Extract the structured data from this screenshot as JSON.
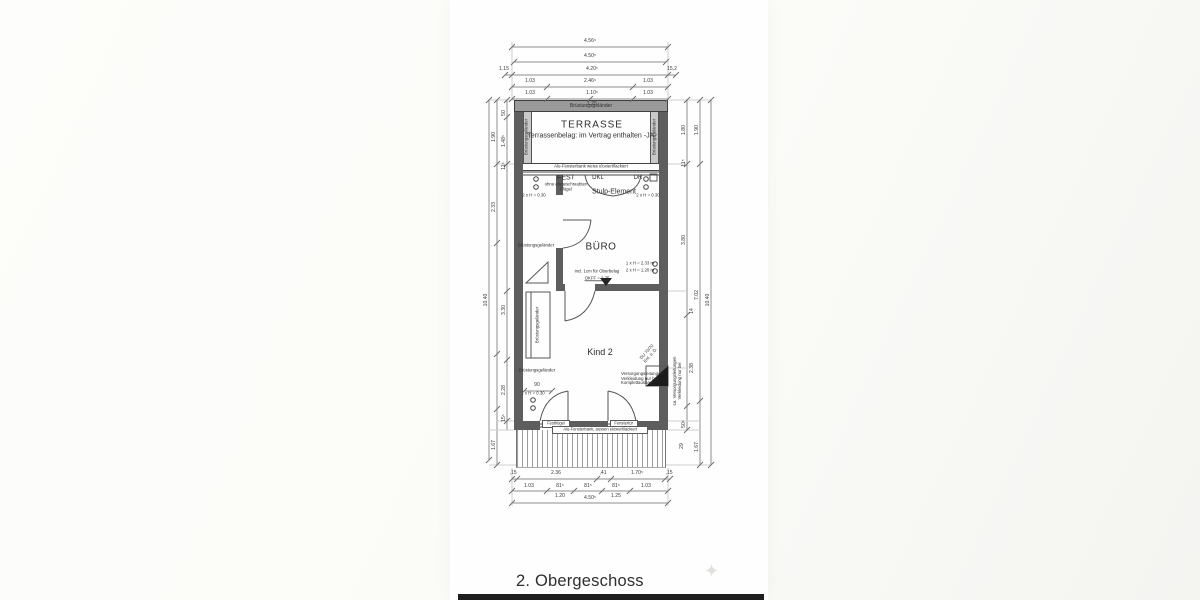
{
  "title": "2. Obergeschoss",
  "decor": {
    "sparkle": "✦"
  },
  "plan": {
    "rooms": {
      "terrace": "TERRASSE",
      "terrace_note": "Terrassenbelag: im Vertrag enthalten -JA-",
      "office": "BÜRO",
      "child": "Kind 2"
    },
    "labels": {
      "railing": "Brüstungsgeländer",
      "sill_top": "Alu-Fensterbank weiss eloxiert/lackiert",
      "sill_bottom": "Alu-Fensterbank, aussen eloxiert/lackiert",
      "fixed": "FEST",
      "fixed_sub1": "ohne eingeschraubten",
      "fixed_sub2": "Flügel",
      "dkl": "DKL",
      "dr": "DR",
      "stulp": "Stulp-Element",
      "sockets_030": "2 x H = 0.30",
      "floor_note1": "incl. 1cm für Oberbelag",
      "floor_note2": "OKFF = 2.75",
      "h1": "1 x H = 2.33 m",
      "h2": "2 x H = 1.20 m",
      "shower": "DU 70/70",
      "vent": "Ent. ü. D.",
      "supply1": "Versorgungsleitungen",
      "supply2": "Verkleidung nur bei",
      "supply3": "Komplettausbau",
      "supply_side1": "ca. Versorgungsleitungen",
      "supply_side2": "Verkleidung nur bei",
      "door_left": "Festflügel",
      "door_right": "Fenstertür",
      "dim_90": "90"
    }
  },
  "dims": {
    "top": {
      "t1": "4.56⁵",
      "t2": "4.50⁵",
      "t3l": "1.15",
      "t3": "4.20⁵",
      "t3r": "15,2",
      "t4l": "1.03",
      "t4": "2.46⁵",
      "t4r": "1.03",
      "t5l": "1.03",
      "t5": "1.10⁵",
      "t5r": "1.03",
      "t5sub": "1.25"
    },
    "bottom": {
      "b1a": ",15",
      "b1b": "2.36",
      "b1c": ",41",
      "b1d": "1.70⁵",
      "b1e": ",15",
      "b2a": "1.03",
      "b2b": "81⁵",
      "b2c": "81⁵",
      "b2d": "81⁵",
      "b2e": "1.03",
      "b2sub1": "1.20",
      "b2sub2": "1.25",
      "b3": "4.50⁵"
    },
    "left": {
      "total": "10.40",
      "a": "1.90",
      "b": "2.33",
      "c": "1.67",
      "d": "50",
      "e": "1.48⁵",
      "f": "11⁵",
      "g": "3.30",
      "h": "2.28",
      "i": "15⁵"
    },
    "right": {
      "total": "10.40",
      "a": "1.90",
      "b": "7.02",
      "c": "1.67",
      "d": "1.80",
      "e": "11⁵",
      "f": "3.80",
      "g": "14",
      "h": "2.38",
      "i": "50⁵",
      "j": "29"
    }
  }
}
